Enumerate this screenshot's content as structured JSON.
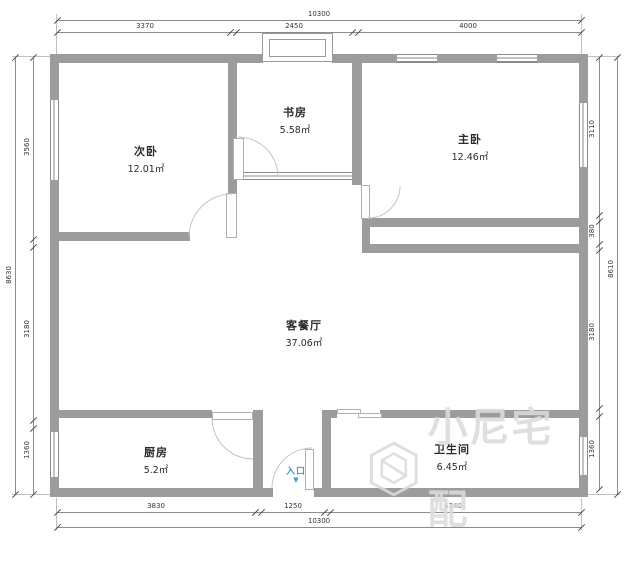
{
  "rooms": [
    {
      "name": "次卧",
      "area": "12.01㎡"
    },
    {
      "name": "书房",
      "area": "5.58㎡"
    },
    {
      "name": "主卧",
      "area": "12.46㎡"
    },
    {
      "name": "客餐厅",
      "area": "37.06㎡"
    },
    {
      "name": "厨房",
      "area": "5.2㎡"
    },
    {
      "name": "卫生间",
      "area": "6.45㎡"
    }
  ],
  "entrance": {
    "label": "入口",
    "arrow": "▼"
  },
  "dimensions": {
    "top": {
      "overall": "10300",
      "segments": [
        "3370",
        "2450",
        "4000"
      ]
    },
    "bottom": {
      "overall": "10300",
      "segments": [
        "3830",
        "1250",
        "4740"
      ]
    },
    "left": {
      "overall": "8630",
      "segments": [
        "3560",
        "3180",
        "1360"
      ]
    },
    "right": {
      "overall": "8610",
      "segments": [
        "3110",
        "380",
        "3180",
        "1360"
      ]
    }
  },
  "watermark": {
    "text": "小尼宅配",
    "logo": "cube-logo"
  },
  "colors": {
    "wall": "#9c9c9c",
    "dimension_text": "#333333",
    "entrance_blue": "#3f9ad1",
    "watermark": "#dbdbdb"
  }
}
